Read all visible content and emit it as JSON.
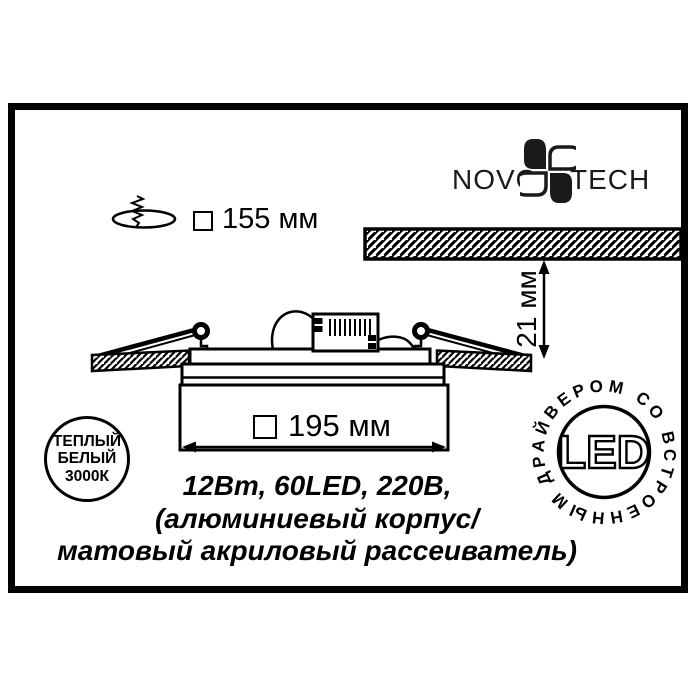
{
  "brand": {
    "name_left": "NOVO",
    "name_right": "TECH",
    "flower_icon": "novotech-flower"
  },
  "dimensions": {
    "cutout": "155 мм",
    "body_width": "195 мм",
    "recess_depth": "21 мм",
    "square_symbol": "□"
  },
  "badges": {
    "warm_white": {
      "line1": "ТЕПЛЫЙ",
      "line2": "БЕЛЫЙ",
      "line3": "3000К"
    },
    "led": {
      "center": "LED",
      "ring_text": "ДРАЙВЕРОМ СО ВСТРОЕННЫМ"
    }
  },
  "specs": {
    "line1": "12Вт, 60LED, 220В,",
    "line2": "(алюминиевый корпус/",
    "line3": "матовый акриловый рассеиватель)"
  },
  "icons": {
    "drill": "drill-cutout-icon"
  },
  "colors": {
    "ink": "#000000",
    "background": "#ffffff"
  }
}
